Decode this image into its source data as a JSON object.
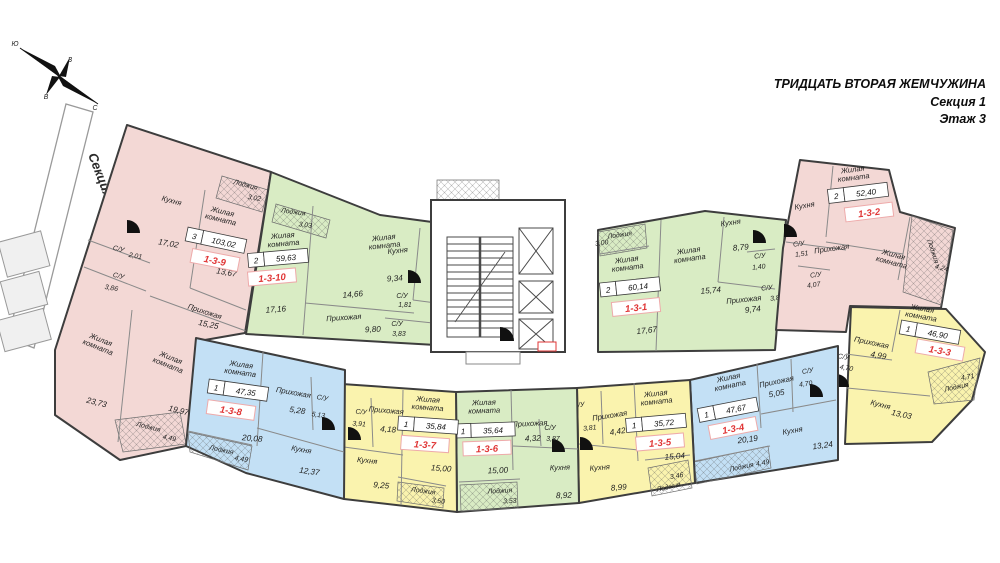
{
  "title": {
    "project": "ТРИДЦАТЬ ВТОРАЯ ЖЕМЧУЖИНА",
    "section": "Секция 1",
    "floor": "Этаж 3"
  },
  "neighbor_section_label": "Секция 2",
  "compass": {
    "north": "С",
    "south": "Ю",
    "east": "В",
    "west": "З"
  },
  "colors": {
    "pink": "#f3d8d5",
    "green": "#d9ecc4",
    "blue": "#c3e0f5",
    "yellow": "#faf3ae",
    "unit_id_red": "#e03535",
    "unit_id_border": "#eeaaaa",
    "wall": "#3d3d3d"
  },
  "apartments": [
    {
      "id": "1-3-9",
      "rooms_count": "3",
      "total_area": "103,02",
      "rooms": [
        {
          "name": "Кухня",
          "area": "17,02"
        },
        {
          "name": "Лоджия",
          "area": "3,02"
        },
        {
          "name": "Жилая\nкомната",
          "area": "13,67"
        },
        {
          "name": "Прихожая",
          "area": "15,25"
        },
        {
          "name": "С/У",
          "area": "2,01"
        },
        {
          "name": "С/У",
          "area": "3,86"
        },
        {
          "name": "Жилая\nкомната",
          "area": "23,73"
        },
        {
          "name": "Жилая\nкомната",
          "area": "19,97"
        },
        {
          "name": "Лоджия",
          "area": "4,49"
        }
      ]
    },
    {
      "id": "1-3-10",
      "rooms_count": "2",
      "total_area": "59,63",
      "rooms": [
        {
          "name": "Лоджия",
          "area": "3,03"
        },
        {
          "name": "Жилая\nкомната",
          "area": "17,16"
        },
        {
          "name": "Жилая\nкомната",
          "area": "14,66"
        },
        {
          "name": "Кухня",
          "area": "9,34"
        },
        {
          "name": "С/У",
          "area": "1,81"
        },
        {
          "name": "Прихожая",
          "area": "9,80"
        },
        {
          "name": "С/У",
          "area": "3,83"
        }
      ]
    },
    {
      "id": "1-3-1",
      "rooms_count": "2",
      "total_area": "60,14",
      "rooms": [
        {
          "name": "Лоджия",
          "area": "3,00"
        },
        {
          "name": "Жилая\nкомната",
          "area": "17,67"
        },
        {
          "name": "Жилая\nкомната",
          "area": "15,74"
        },
        {
          "name": "Кухня",
          "area": "8,79"
        },
        {
          "name": "С/У",
          "area": "1,40"
        },
        {
          "name": "Прихожая",
          "area": "9,74"
        },
        {
          "name": "С/У",
          "area": "3,80"
        }
      ]
    },
    {
      "id": "1-3-2",
      "rooms_count": "2",
      "total_area": "52,40",
      "rooms": [
        {
          "name": "Кухня"
        },
        {
          "name": "Жилая\nкомната"
        },
        {
          "name": "С/У",
          "area": "1,51"
        },
        {
          "name": "Прихожая"
        },
        {
          "name": "С/У",
          "area": "4,07"
        },
        {
          "name": "Жилая\nкомната"
        },
        {
          "name": "Лоджия",
          "area": "4,24"
        }
      ]
    },
    {
      "id": "1-3-3",
      "rooms_count": "1",
      "total_area": "46,90",
      "rooms": [
        {
          "name": "Жилая\nкомната"
        },
        {
          "name": "Прихожая",
          "area": "4,99"
        },
        {
          "name": "С/У",
          "area": "4,70"
        },
        {
          "name": "Кухня",
          "area": "13,03"
        },
        {
          "name": "Лоджия",
          "area": "4,71"
        }
      ]
    },
    {
      "id": "1-3-4",
      "rooms_count": "1",
      "total_area": "47,67",
      "rooms": [
        {
          "name": "Жилая\nкомната",
          "area": "20,19"
        },
        {
          "name": "Прихожая",
          "area": "5,05"
        },
        {
          "name": "С/У",
          "area": "4,70"
        },
        {
          "name": "Кухня",
          "area": "13,24"
        },
        {
          "name": "Лоджия",
          "area": "4,49"
        }
      ]
    },
    {
      "id": "1-3-5",
      "rooms_count": "1",
      "total_area": "35,72",
      "rooms": [
        {
          "name": "Жилая\nкомната",
          "area": "15,04"
        },
        {
          "name": "Прихожая",
          "area": "4,42"
        },
        {
          "name": "С/У",
          "area": "3,81"
        },
        {
          "name": "Кухня",
          "area": "8,99"
        },
        {
          "name": "Лоджия",
          "area": "3,46"
        }
      ]
    },
    {
      "id": "1-3-6",
      "rooms_count": "1",
      "total_area": "35,64",
      "rooms": [
        {
          "name": "Жилая\nкомната",
          "area": "15,00"
        },
        {
          "name": "Прихожая",
          "area": "4,32"
        },
        {
          "name": "С/У",
          "area": "3,87"
        },
        {
          "name": "Кухня",
          "area": "8,92"
        },
        {
          "name": "Лоджия",
          "area": "3,53"
        }
      ]
    },
    {
      "id": "1-3-7",
      "rooms_count": "1",
      "total_area": "35,84",
      "rooms": [
        {
          "name": "Жилая\nкомната",
          "area": "15,00"
        },
        {
          "name": "Прихожая",
          "area": "4,18"
        },
        {
          "name": "С/У",
          "area": "3,91"
        },
        {
          "name": "Кухня",
          "area": "9,25"
        },
        {
          "name": "Лоджия",
          "area": "3,50"
        }
      ]
    },
    {
      "id": "1-3-8",
      "rooms_count": "1",
      "total_area": "47,35",
      "rooms": [
        {
          "name": "Жилая\nкомната",
          "area": "20,08"
        },
        {
          "name": "Прихожая",
          "area": "5,28"
        },
        {
          "name": "С/У",
          "area": "5,13"
        },
        {
          "name": "Кухня",
          "area": "12,37"
        },
        {
          "name": "Лоджия",
          "area": "4,49"
        }
      ]
    }
  ]
}
